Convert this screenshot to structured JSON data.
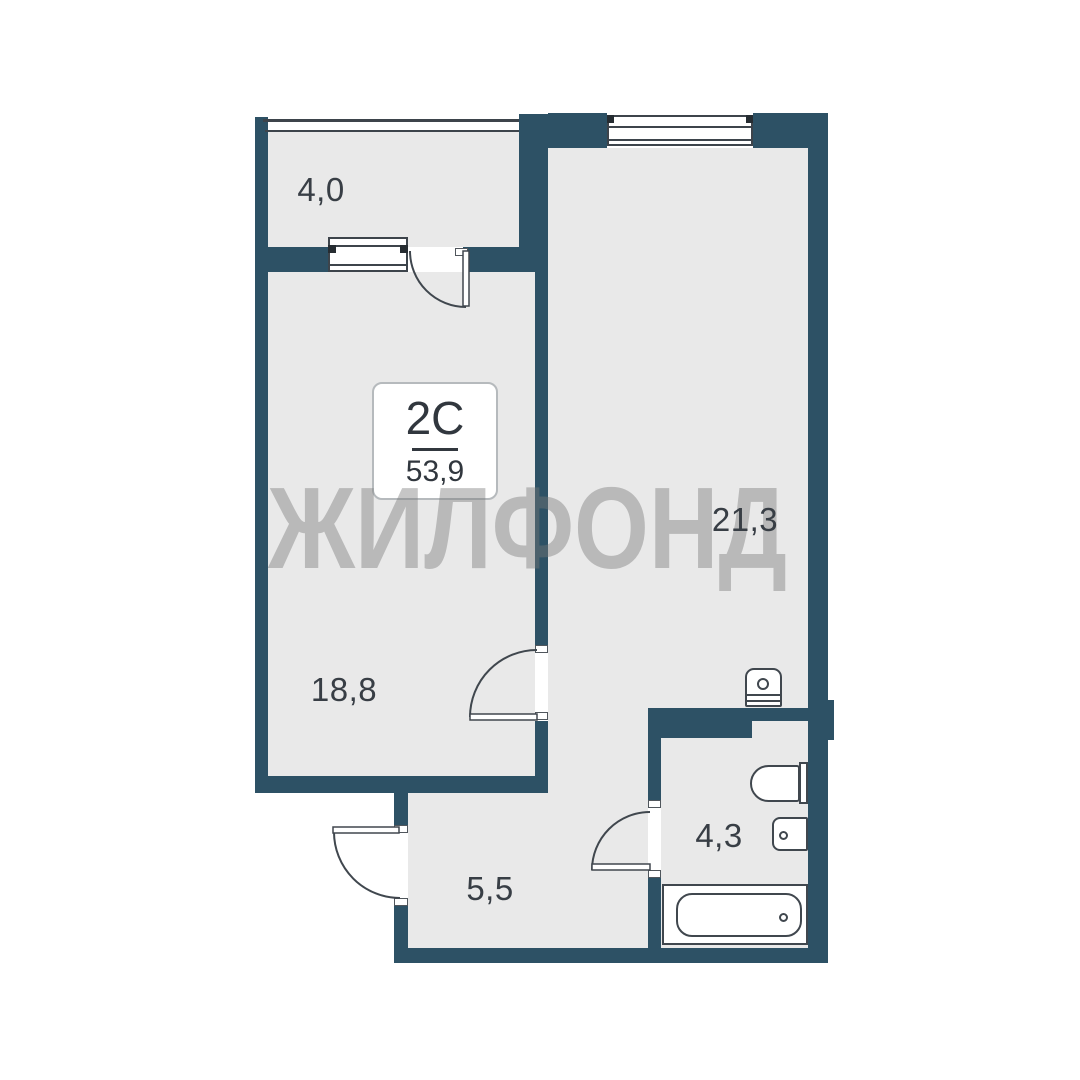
{
  "unit": {
    "type": "2C",
    "total_area": "53,9"
  },
  "watermark_text": "ЖИЛФОНД",
  "rooms": {
    "balcony": {
      "area": "4,0"
    },
    "living_room": {
      "area": "21,3"
    },
    "bedroom": {
      "area": "18,8"
    },
    "hallway": {
      "area": "5,5"
    },
    "bathroom": {
      "area": "4,3"
    }
  },
  "fixtures": [
    "washing-machine",
    "toilet",
    "sink",
    "bathtub"
  ],
  "colors": {
    "wall": "#2d5165",
    "floor": "#e9e9e9",
    "line": "#40474e",
    "watermark_gray": "#bdbdbd",
    "label_text": "#383e45",
    "background": "#ffffff"
  }
}
